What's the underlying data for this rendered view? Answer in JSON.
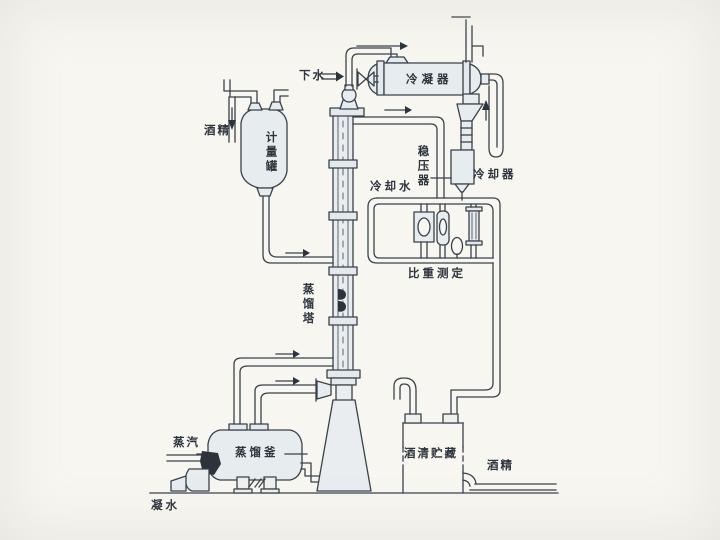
{
  "figure": {
    "type": "process-flow-diagram",
    "subject": "alcohol distillation system"
  },
  "labels": {
    "drain_water": {
      "text": "下水"
    },
    "condenser": {
      "text": "冷凝器"
    },
    "stabilizer": {
      "text": "稳压器"
    },
    "cooling_water": {
      "text": "冷却水"
    },
    "cooler": {
      "text": "冷却器"
    },
    "gravity_measure": {
      "text": "比重测定"
    },
    "alcohol_feed": {
      "text": "酒精"
    },
    "metering_tank": {
      "text": "计量罐"
    },
    "distillation_column": {
      "text": "蒸馏塔"
    },
    "distillation_kettle": {
      "text": "蒸馏釜"
    },
    "steam": {
      "text": "蒸汽"
    },
    "condensate": {
      "text": "凝水"
    },
    "alcohol_storage": {
      "text": "酒清贮藏"
    },
    "alcohol_out": {
      "text": "酒精"
    }
  },
  "colors": {
    "ink": "#39424b",
    "paper": "#f7f6f1",
    "vessel_fill": "#e7ecef"
  }
}
